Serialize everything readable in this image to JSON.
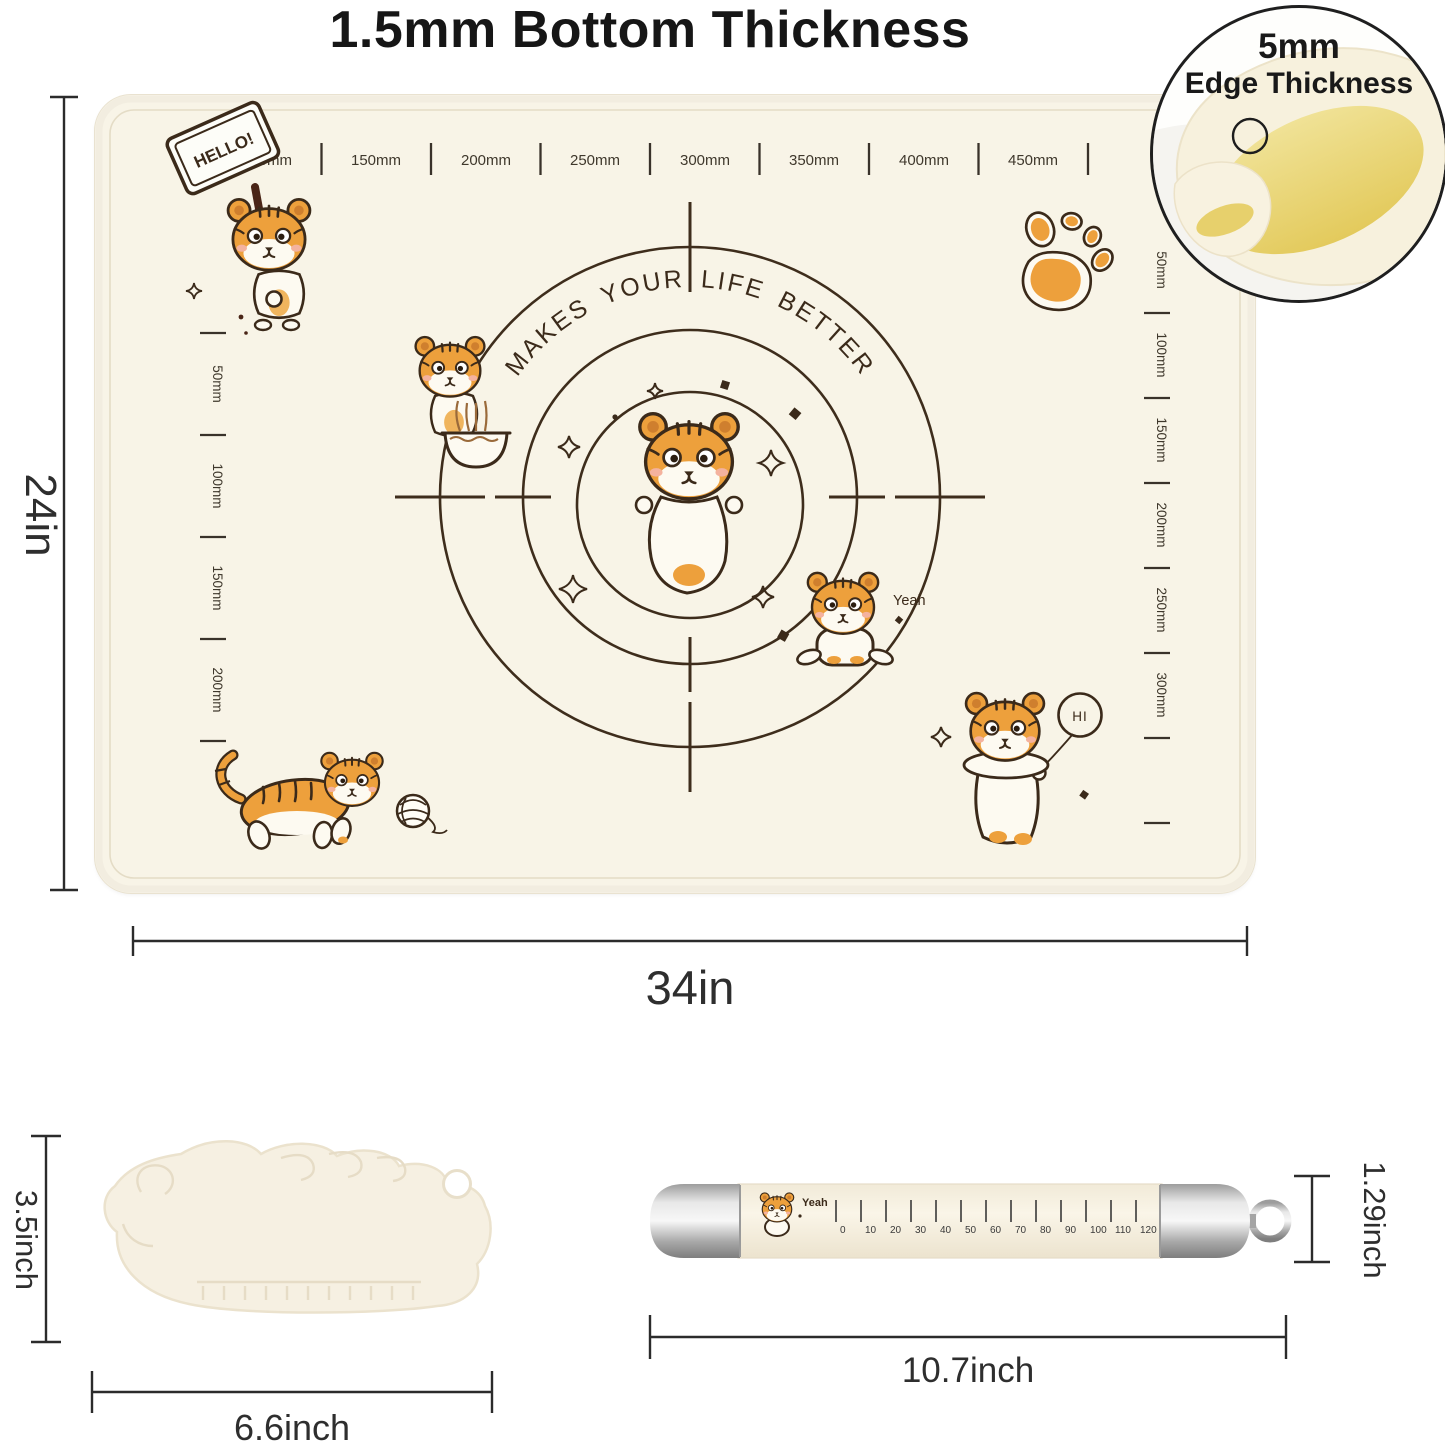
{
  "title": {
    "text": "1.5mm Bottom Thickness"
  },
  "edge_inset": {
    "size_label": "5mm",
    "caption": "Edge Thickness"
  },
  "mat": {
    "height_label": "24in",
    "width_label": "34in",
    "arc_text": "MAKES  YOUR  LIFE  BETTER",
    "top_ruler_labels": [
      "100mm",
      "150mm",
      "200mm",
      "250mm",
      "300mm",
      "350mm",
      "400mm",
      "450mm"
    ],
    "left_ruler_labels": [
      "50mm",
      "100mm",
      "150mm",
      "200mm"
    ],
    "right_ruler_labels": [
      "50mm",
      "100mm",
      "150mm",
      "200mm",
      "250mm",
      "300mm"
    ],
    "stickers": {
      "hello_sign": "HELLO!",
      "yeah_text": "Yeah",
      "hi_balloon": "HI"
    }
  },
  "scraper": {
    "height_label": "3.5inch",
    "width_label": "6.6inch"
  },
  "rolling_pin": {
    "decal_text": "Yeah",
    "scale_labels": [
      "0",
      "10",
      "20",
      "30",
      "40",
      "50",
      "60",
      "70",
      "80",
      "90",
      "100",
      "110",
      "120"
    ],
    "length_label": "10.7inch",
    "diameter_label": "1.29inch"
  },
  "colors": {
    "mat_surface": "#f8f4e7",
    "line_art": "#3b2a1a",
    "tiger_orange": "#eda03c",
    "fold_yellow": "#e9d26f",
    "dimension_line": "#2b2b2b",
    "pin_body": "#f6f0e1",
    "silver": "#c6c6c6"
  }
}
